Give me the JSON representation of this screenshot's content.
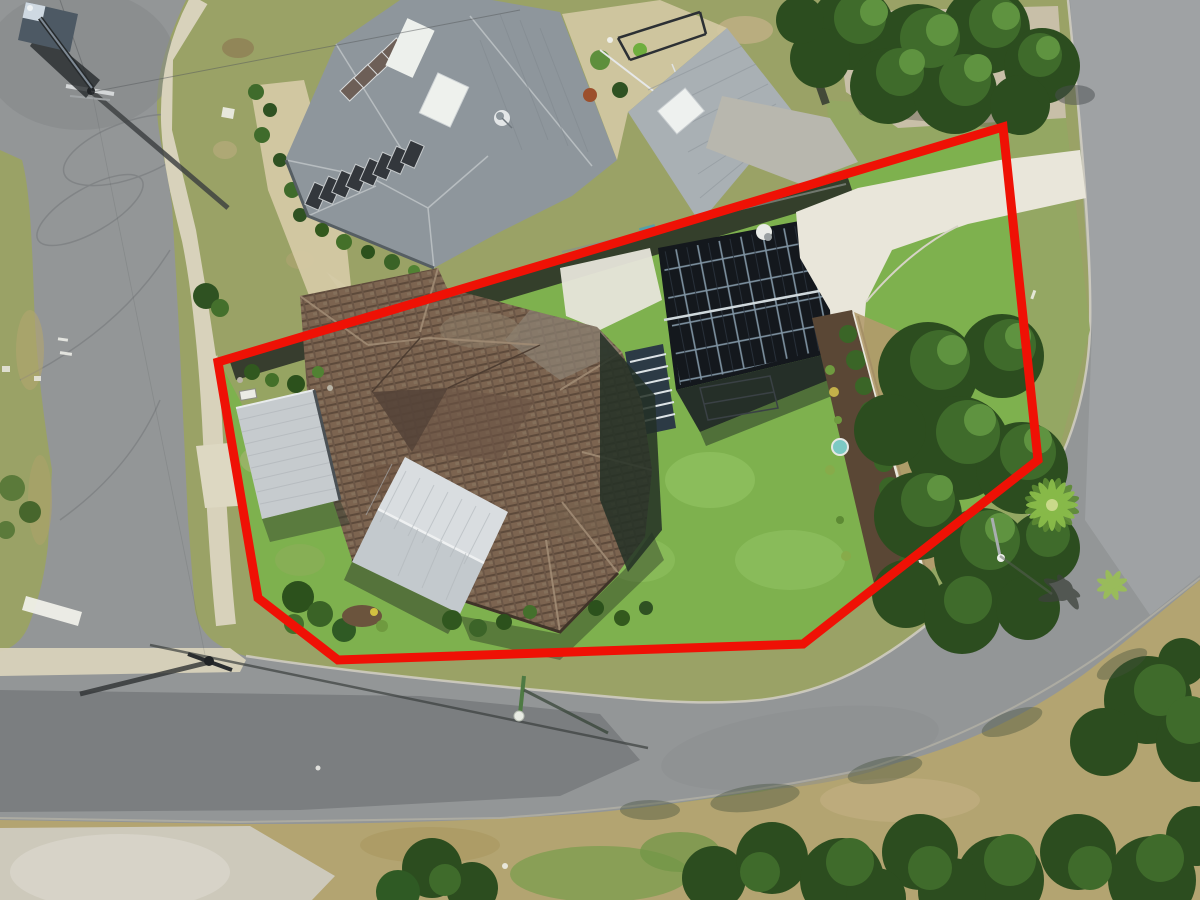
{
  "meta": {
    "image_type": "aerial-drone-photograph",
    "description": "Top-down aerial photo of a corner-lot residential property outlined with a thick red boundary overlay; tiled-roof house with carport, patio roof and solar-covered garage inside the boundary; neighbouring metal-roof house above; curving suburban roads on the left, bottom and right; dense trees along the right side."
  },
  "boundary": {
    "shape": "polygon",
    "color": "#ef1105",
    "stroke_width": 9,
    "points": "1003,127 218,362 258,598 338,660 803,644 1038,460"
  },
  "palette": {
    "asphalt": "#939697",
    "asphalt_light": "#a9acad",
    "asphalt_dark": "#737678",
    "concrete": "#e9e6da",
    "footpath": "#d8d2bb",
    "sand_path": "#d4c9a4",
    "grass_olive": "#9aa266",
    "grass_tan": "#c0b086",
    "lawn": "#7eb14e",
    "lawn_light": "#9ccb6d",
    "verge_tan": "#b3a471",
    "sand": "#cdc9bb",
    "gravel": "#c8bfa8",
    "metal_roof": "#8e969c",
    "metal_roof_light": "#a9b0b4",
    "carport": "#c6cbce",
    "patio_light": "#d9dde0",
    "patio_dark": "#c3c9cd",
    "tile_brown": "#7c6450",
    "solar_dark": "#14181d",
    "tree_dark": "#2c4d1f",
    "tree_mid": "#3f6b2b",
    "tree_light": "#5f9340",
    "palm": "#8abc4a",
    "hedge": "#3a6527",
    "mulch": "#5a4735",
    "wall_dark": "#23282c",
    "wall_cap": "#e9e7dd",
    "pond": "#7cc9c3",
    "white_paint": "#f2f2ec"
  },
  "scene": {
    "objects": [
      "property-boundary-outline",
      "subject-house-tile-roof",
      "carport-roof",
      "patio-gable-roof",
      "garage-solar-array",
      "external-stair",
      "clothesline",
      "garden-bed-hedge",
      "bird-bath",
      "white-driveway",
      "neighbor-house-roof",
      "neighbor-solar-panels",
      "neighbor-skylights",
      "satellite-dish",
      "neighbor-second-roof",
      "pergola-frame",
      "left-road",
      "bottom-road",
      "right-road",
      "footpaths",
      "give-way-line",
      "power-poles",
      "street-lights",
      "crane-truck",
      "tree-clusters",
      "palm-tree",
      "front-lawn",
      "rear-lawn"
    ]
  }
}
